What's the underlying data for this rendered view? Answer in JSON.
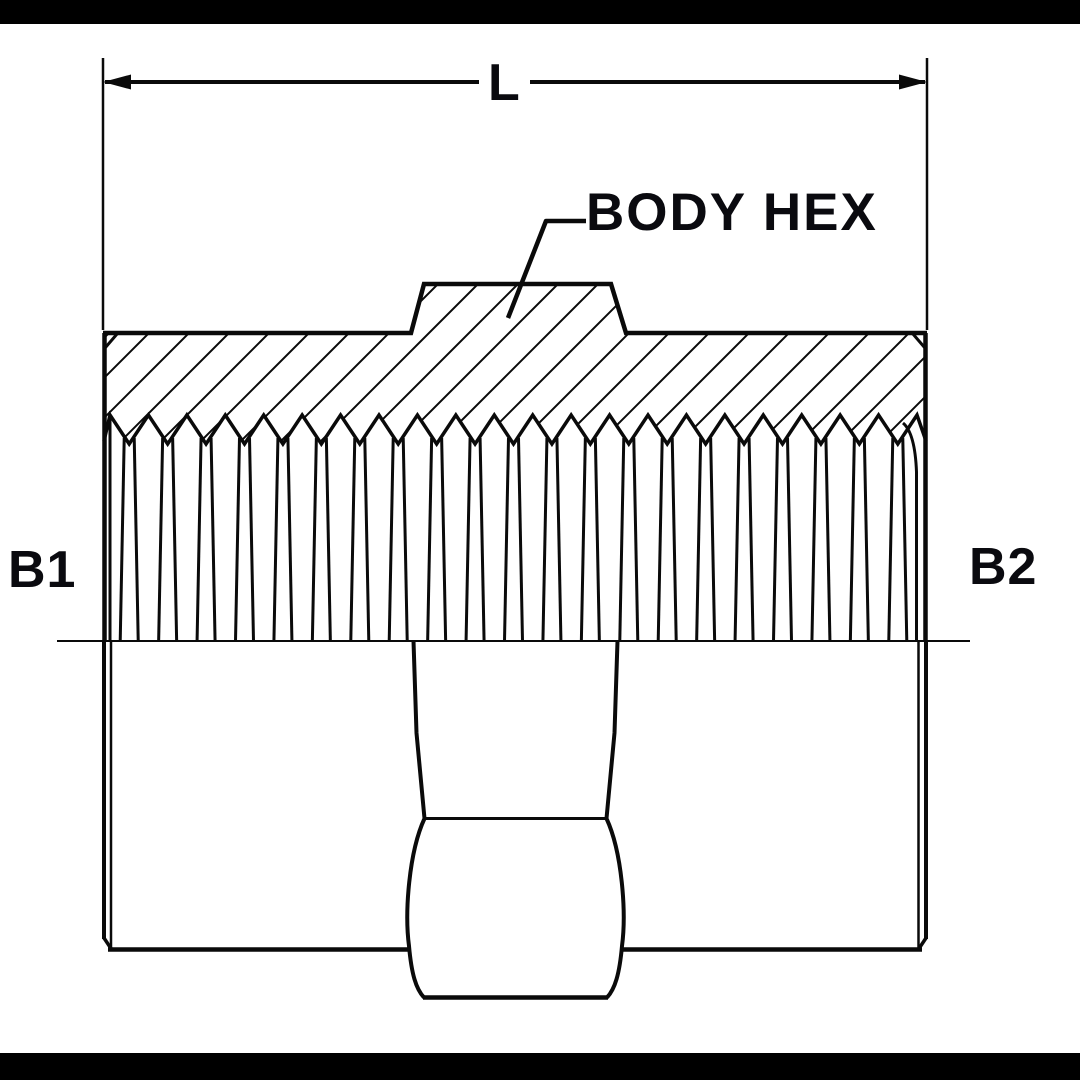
{
  "page": {
    "background_color": "#ffffff",
    "letterbox_color": "#000000",
    "line_color": "#0a0a0a",
    "text_color": "#0a0a0f"
  },
  "drawing": {
    "kind": "sectioned pipe coupling / hex nipple technical line drawing",
    "dimension_label": "L",
    "callout_label": "BODY HEX",
    "port_left_label": "B1",
    "port_right_label": "B2"
  }
}
